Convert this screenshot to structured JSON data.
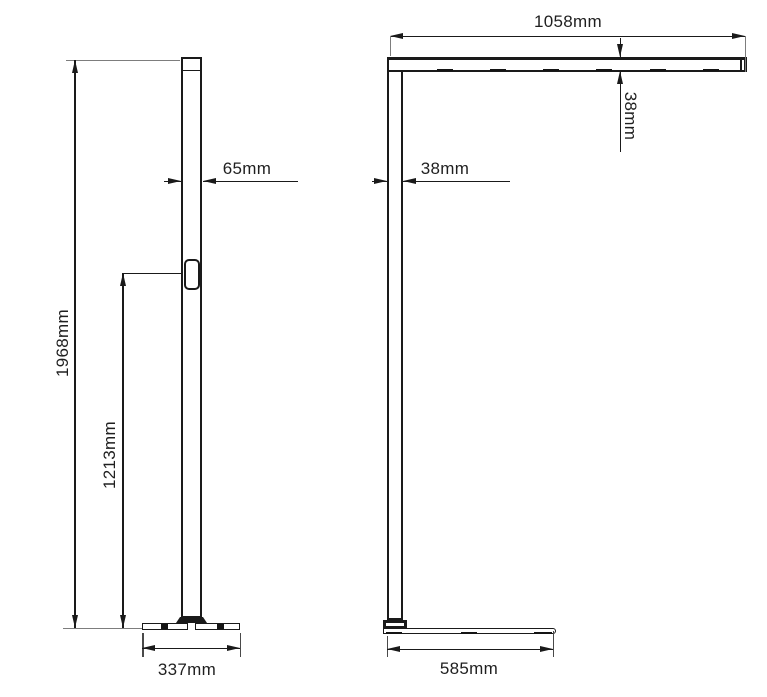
{
  "drawing": {
    "type": "technical-dimension-drawing",
    "subject": "floor lamp front and side elevation",
    "unit": "mm",
    "front_view": {
      "total_height": "1968mm",
      "switch_height": "1213mm",
      "pole_width": "65mm",
      "base_width": "337mm"
    },
    "side_view": {
      "head_length": "1058mm",
      "head_thickness": "38mm",
      "pole_depth": "38mm",
      "base_depth": "585mm"
    },
    "colors": {
      "line": "#1a1a1a",
      "extension_line": "#7d7d7d",
      "background": "#ffffff"
    }
  }
}
